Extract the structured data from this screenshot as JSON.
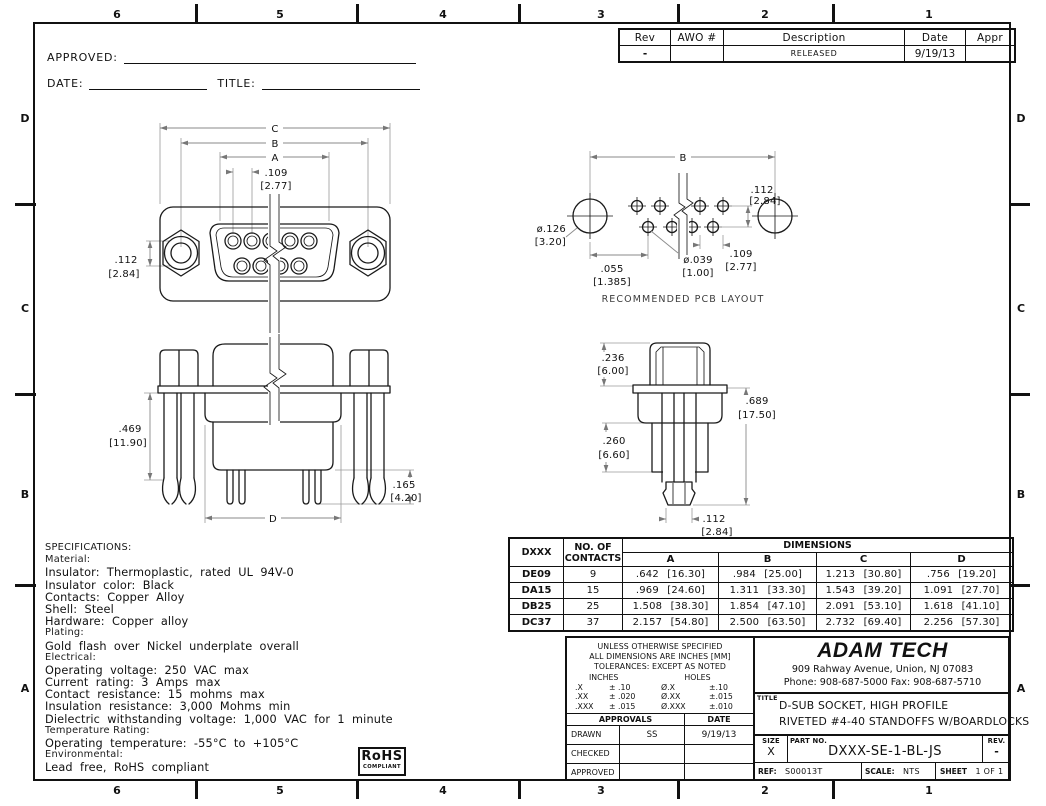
{
  "zones": {
    "top": [
      "6",
      "5",
      "4",
      "3",
      "2",
      "1"
    ],
    "bottom": [
      "6",
      "5",
      "4",
      "3",
      "2",
      "1"
    ],
    "left": [
      "D",
      "C",
      "B",
      "A"
    ],
    "right": [
      "D",
      "C",
      "B",
      "A"
    ]
  },
  "signoff": {
    "approved_label": "APPROVED:",
    "date_label": "DATE:",
    "title_label": "TITLE:"
  },
  "revision_table": {
    "headers": [
      "Rev",
      "AWO #",
      "Description",
      "Date",
      "Appr"
    ],
    "row": {
      "rev": "-",
      "awo": "",
      "description": "RELEASED",
      "date": "9/19/13",
      "appr": ""
    }
  },
  "views": {
    "front": {
      "c": "C",
      "b": "B",
      "a": "A",
      "pitch": ".109",
      "pitch_mm": "[2.77]",
      "row": ".112",
      "row_mm": "[2.84]"
    },
    "pcb": {
      "caption": "RECOMMENDED PCB LAYOUT",
      "b": "B",
      "mount_dia": "ø.126",
      "mount_dia_mm": "[3.20]",
      "offset": ".055",
      "offset_mm": "[1.385]",
      "hole_dia": "ø.039",
      "hole_dia_mm": "[1.00]",
      "pitch": ".109",
      "pitch_mm": "[2.77]",
      "row": ".112",
      "row_mm": "[2.84]"
    },
    "bottom": {
      "height": ".469",
      "height_mm": "[11.90]",
      "pin": ".165",
      "pin_mm": "[4.20]",
      "d": "D"
    },
    "side": {
      "top": ".236",
      "top_mm": "[6.00]",
      "overall": ".689",
      "overall_mm": "[17.50]",
      "mid": ".260",
      "mid_mm": "[6.60]",
      "tip": ".112",
      "tip_mm": "[2.84]"
    }
  },
  "specifications": {
    "lines": [
      {
        "text": "SPECIFICATIONS:"
      },
      {
        "text": "Material:"
      },
      {
        "text": "Insulator: Thermoplastic, rated UL 94V-0"
      },
      {
        "text": "Insulator color: Black"
      },
      {
        "text": "Contacts: Copper Alloy"
      },
      {
        "text": "Shell: Steel"
      },
      {
        "text": "Hardware: Copper alloy"
      },
      {
        "text": "Plating:"
      },
      {
        "text": "Gold flash over Nickel underplate overall"
      },
      {
        "text": "Electrical:"
      },
      {
        "text": "Operating voltage: 250 VAC max"
      },
      {
        "text": "Current rating: 3 Amps max"
      },
      {
        "text": "Contact resistance: 15 mohms max"
      },
      {
        "text": "Insulation resistance: 3,000 Mohms min"
      },
      {
        "text": "Dielectric withstanding voltage: 1,000 VAC for 1 minute"
      },
      {
        "text": "Temperature Rating:"
      },
      {
        "text": "Operating temperature: -55°C to +105°C"
      },
      {
        "text": "Environmental:"
      },
      {
        "text": "Lead free, RoHS compliant"
      }
    ]
  },
  "dimensions_table": {
    "model_header": "DXXX",
    "contacts_header_1": "NO. OF",
    "contacts_header_2": "CONTACTS",
    "group_header": "DIMENSIONS",
    "dim_headers": [
      "A",
      "B",
      "C",
      "D"
    ],
    "rows": [
      {
        "model": "DE09",
        "contacts": "9",
        "a": ".642 [16.30]",
        "b": ".984 [25.00]",
        "c": "1.213 [30.80]",
        "d": ".756 [19.20]"
      },
      {
        "model": "DA15",
        "contacts": "15",
        "a": ".969 [24.60]",
        "b": "1.311 [33.30]",
        "c": "1.543 [39.20]",
        "d": "1.091 [27.70]"
      },
      {
        "model": "DB25",
        "contacts": "25",
        "a": "1.508 [38.30]",
        "b": "1.854 [47.10]",
        "c": "2.091 [53.10]",
        "d": "1.618 [41.10]"
      },
      {
        "model": "DC37",
        "contacts": "37",
        "a": "2.157 [54.80]",
        "b": "2.500 [63.50]",
        "c": "2.732 [69.40]",
        "d": "2.256 [57.30]"
      }
    ]
  },
  "title_block": {
    "notes": [
      "UNLESS OTHERWISE SPECIFIED",
      "ALL DIMENSIONS ARE INCHES [MM]",
      "TOLERANCES: EXCEPT AS NOTED"
    ],
    "inches_header": "INCHES",
    "holes_header": "HOLES",
    "tol_rows": [
      {
        "c1": ".X",
        "c2": "± .10",
        "c3": "Ø.X",
        "c4": "±.10"
      },
      {
        "c1": ".XX",
        "c2": "± .020",
        "c3": "Ø.XX",
        "c4": "±.015"
      },
      {
        "c1": ".XXX",
        "c2": "± .015",
        "c3": "Ø.XXX",
        "c4": "±.010"
      }
    ],
    "approvals_header": "APPROVALS",
    "date_header": "DATE",
    "approval_rows": [
      {
        "role": "DRAWN",
        "name": "SS",
        "date": "9/19/13"
      },
      {
        "role": "CHECKED",
        "name": "",
        "date": ""
      },
      {
        "role": "APPROVED",
        "name": "",
        "date": ""
      }
    ],
    "company_name": "ADAM TECH",
    "company_address": "909 Rahway Avenue, Union, NJ 07083",
    "company_phone": "Phone: 908-687-5000 Fax: 908-687-5710",
    "title_label": "TITLE",
    "title_line1": "D-SUB SOCKET, HIGH PROFILE",
    "title_line2": "RIVETED #4-40 STANDOFFS W/BOARDLOCKS",
    "size_label": "SIZE",
    "size_value": "X",
    "part_label": "PART NO.",
    "part_value": "DXXX-SE-1-BL-JS",
    "rev_label": "REV.",
    "rev_value": "-",
    "ref_label": "REF:",
    "ref_value": "S00013T",
    "scale_label": "SCALE:",
    "scale_value": "NTS",
    "sheet_label": "SHEET",
    "sheet_value": "1 OF 1"
  },
  "rohs": {
    "line1": "RoHS",
    "line2": "COMPLIANT"
  }
}
